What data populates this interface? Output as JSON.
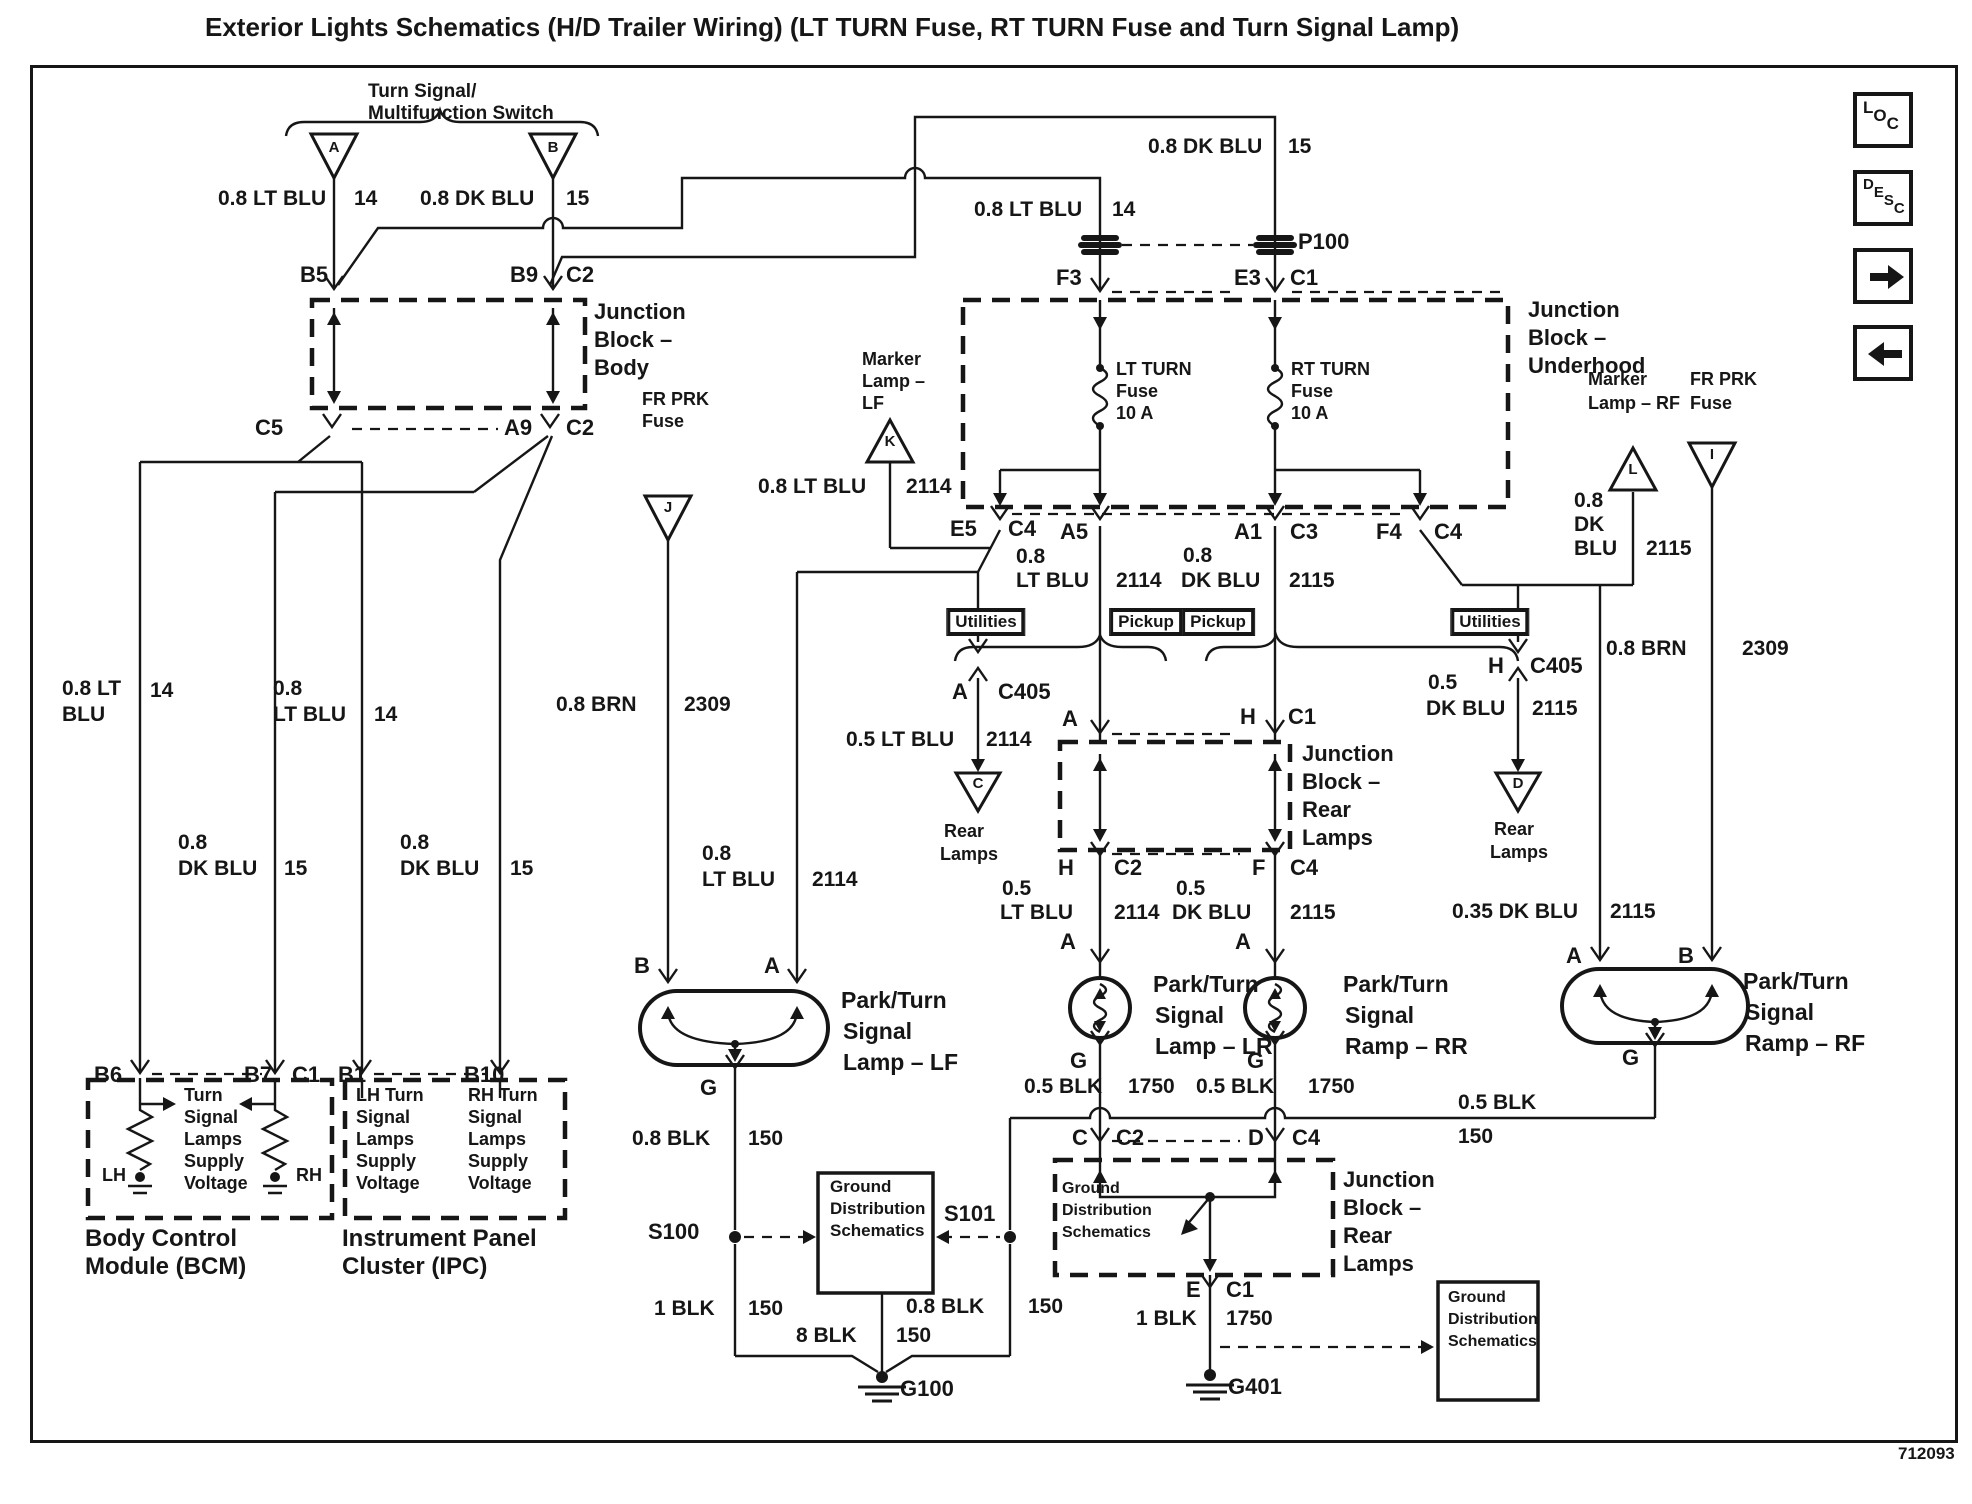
{
  "title": "Exterior Lights Schematics (H/D Trailer Wiring) (LT TURN Fuse, RT TURN Fuse and Turn Signal Lamp)",
  "part_number": "712093",
  "toolbar": {
    "loc_label": "LOC",
    "desc_label": "DESC",
    "next_icon": "right-arrow",
    "prev_icon": "left-arrow"
  },
  "colors": {
    "ink": "#161616",
    "paper": "#ffffff"
  },
  "labels": [
    {
      "t": "Turn Signal/",
      "x": 368,
      "y": 82,
      "s": 19
    },
    {
      "t": "Multifunction Switch",
      "x": 368,
      "y": 104,
      "s": 19
    },
    {
      "t": "A",
      "x": 334,
      "y": 140,
      "s": 15,
      "a": "c"
    },
    {
      "t": "B",
      "x": 553,
      "y": 140,
      "s": 15,
      "a": "c"
    },
    {
      "t": "0.8 LT BLU",
      "x": 218,
      "y": 188,
      "s": 21
    },
    {
      "t": "14",
      "x": 354,
      "y": 188,
      "s": 21
    },
    {
      "t": "0.8 DK BLU",
      "x": 420,
      "y": 188,
      "s": 21
    },
    {
      "t": "15",
      "x": 566,
      "y": 188,
      "s": 21
    },
    {
      "t": "B5",
      "x": 300,
      "y": 263,
      "s": 22
    },
    {
      "t": "B9",
      "x": 510,
      "y": 263,
      "s": 22
    },
    {
      "t": "C2",
      "x": 566,
      "y": 263,
      "s": 22
    },
    {
      "t": "Junction",
      "x": 594,
      "y": 300,
      "s": 22
    },
    {
      "t": "Block –",
      "x": 594,
      "y": 328,
      "s": 22
    },
    {
      "t": "Body",
      "x": 594,
      "y": 356,
      "s": 22
    },
    {
      "t": "C5",
      "x": 255,
      "y": 416,
      "s": 22
    },
    {
      "t": "A9",
      "x": 504,
      "y": 416,
      "s": 22
    },
    {
      "t": "C2",
      "x": 566,
      "y": 416,
      "s": 22
    },
    {
      "t": "0.8 DK BLU",
      "x": 1148,
      "y": 136,
      "s": 21
    },
    {
      "t": "15",
      "x": 1288,
      "y": 136,
      "s": 21
    },
    {
      "t": "0.8 LT BLU",
      "x": 974,
      "y": 199,
      "s": 21
    },
    {
      "t": "14",
      "x": 1112,
      "y": 199,
      "s": 21
    },
    {
      "t": "P100",
      "x": 1298,
      "y": 230,
      "s": 22
    },
    {
      "t": "F3",
      "x": 1056,
      "y": 266,
      "s": 22
    },
    {
      "t": "E3",
      "x": 1234,
      "y": 266,
      "s": 22
    },
    {
      "t": "C1",
      "x": 1290,
      "y": 266,
      "s": 22
    },
    {
      "t": "Junction",
      "x": 1528,
      "y": 298,
      "s": 22
    },
    {
      "t": "Block –",
      "x": 1528,
      "y": 326,
      "s": 22
    },
    {
      "t": "Underhood",
      "x": 1528,
      "y": 354,
      "s": 22
    },
    {
      "t": "LT TURN",
      "x": 1116,
      "y": 360,
      "s": 18
    },
    {
      "t": "Fuse",
      "x": 1116,
      "y": 382,
      "s": 18
    },
    {
      "t": "10 A",
      "x": 1116,
      "y": 404,
      "s": 18
    },
    {
      "t": "RT TURN",
      "x": 1291,
      "y": 360,
      "s": 18
    },
    {
      "t": "Fuse",
      "x": 1291,
      "y": 382,
      "s": 18
    },
    {
      "t": "10 A",
      "x": 1291,
      "y": 404,
      "s": 18
    },
    {
      "t": "Marker",
      "x": 862,
      "y": 350,
      "s": 18
    },
    {
      "t": "Lamp –",
      "x": 862,
      "y": 372,
      "s": 18
    },
    {
      "t": "LF",
      "x": 862,
      "y": 394,
      "s": 18
    },
    {
      "t": "K",
      "x": 890,
      "y": 434,
      "s": 15,
      "a": "c"
    },
    {
      "t": "FR PRK",
      "x": 642,
      "y": 390,
      "s": 18
    },
    {
      "t": "Fuse",
      "x": 642,
      "y": 412,
      "s": 18
    },
    {
      "t": "J",
      "x": 668,
      "y": 500,
      "s": 15,
      "a": "c"
    },
    {
      "t": "0.8 LT BLU",
      "x": 758,
      "y": 476,
      "s": 21
    },
    {
      "t": "2114",
      "x": 906,
      "y": 476,
      "s": 21
    },
    {
      "t": "E5",
      "x": 950,
      "y": 517,
      "s": 22
    },
    {
      "t": "C4",
      "x": 1008,
      "y": 517,
      "s": 22
    },
    {
      "t": "A5",
      "x": 1060,
      "y": 520,
      "s": 22
    },
    {
      "t": "A1",
      "x": 1234,
      "y": 520,
      "s": 22
    },
    {
      "t": "C3",
      "x": 1290,
      "y": 520,
      "s": 22
    },
    {
      "t": "F4",
      "x": 1376,
      "y": 520,
      "s": 22
    },
    {
      "t": "C4",
      "x": 1434,
      "y": 520,
      "s": 22
    },
    {
      "t": "0.8",
      "x": 1016,
      "y": 546,
      "s": 21
    },
    {
      "t": "LT BLU",
      "x": 1016,
      "y": 570,
      "s": 21
    },
    {
      "t": "2114",
      "x": 1116,
      "y": 570,
      "s": 21
    },
    {
      "t": "0.8",
      "x": 1183,
      "y": 545,
      "s": 21
    },
    {
      "t": "DK BLU",
      "x": 1181,
      "y": 570,
      "s": 21
    },
    {
      "t": "2115",
      "x": 1289,
      "y": 570,
      "s": 21
    },
    {
      "t": "Marker",
      "x": 1588,
      "y": 370,
      "s": 18
    },
    {
      "t": "Lamp – RF",
      "x": 1588,
      "y": 394,
      "s": 18
    },
    {
      "t": "L",
      "x": 1633,
      "y": 462,
      "s": 15,
      "a": "c"
    },
    {
      "t": "FR PRK",
      "x": 1690,
      "y": 370,
      "s": 18
    },
    {
      "t": "Fuse",
      "x": 1690,
      "y": 394,
      "s": 18
    },
    {
      "t": "I",
      "x": 1712,
      "y": 447,
      "s": 15,
      "a": "c"
    },
    {
      "t": "0.8",
      "x": 1574,
      "y": 490,
      "s": 21
    },
    {
      "t": "DK",
      "x": 1574,
      "y": 514,
      "s": 21
    },
    {
      "t": "BLU",
      "x": 1574,
      "y": 538,
      "s": 21
    },
    {
      "t": "2115",
      "x": 1646,
      "y": 538,
      "s": 21
    },
    {
      "t": "Utilities",
      "x": 986,
      "y": 609,
      "s": 17,
      "a": "c",
      "st": "tag"
    },
    {
      "t": "Pickup",
      "x": 1146,
      "y": 609,
      "s": 17,
      "a": "c",
      "st": "tag"
    },
    {
      "t": "Pickup",
      "x": 1218,
      "y": 609,
      "s": 17,
      "a": "c",
      "st": "tag"
    },
    {
      "t": "Utilities",
      "x": 1490,
      "y": 609,
      "s": 17,
      "a": "c",
      "st": "tag"
    },
    {
      "t": "A",
      "x": 952,
      "y": 680,
      "s": 22
    },
    {
      "t": "C405",
      "x": 998,
      "y": 680,
      "s": 22
    },
    {
      "t": "0.5 LT BLU",
      "x": 846,
      "y": 729,
      "s": 21
    },
    {
      "t": "2114",
      "x": 986,
      "y": 729,
      "s": 21
    },
    {
      "t": "C",
      "x": 978,
      "y": 776,
      "s": 15,
      "a": "c"
    },
    {
      "t": "Rear",
      "x": 944,
      "y": 822,
      "s": 18
    },
    {
      "t": "Lamps",
      "x": 940,
      "y": 845,
      "s": 18
    },
    {
      "t": "H",
      "x": 1488,
      "y": 654,
      "s": 22
    },
    {
      "t": "C405",
      "x": 1530,
      "y": 654,
      "s": 22
    },
    {
      "t": "0.5",
      "x": 1428,
      "y": 672,
      "s": 21
    },
    {
      "t": "DK BLU",
      "x": 1426,
      "y": 698,
      "s": 21
    },
    {
      "t": "2115",
      "x": 1532,
      "y": 698,
      "s": 21
    },
    {
      "t": "D",
      "x": 1518,
      "y": 776,
      "s": 15,
      "a": "c"
    },
    {
      "t": "Rear",
      "x": 1494,
      "y": 820,
      "s": 18
    },
    {
      "t": "Lamps",
      "x": 1490,
      "y": 843,
      "s": 18
    },
    {
      "t": "0.8 BRN",
      "x": 1606,
      "y": 638,
      "s": 21
    },
    {
      "t": "2309",
      "x": 1742,
      "y": 638,
      "s": 21
    },
    {
      "t": "A",
      "x": 1062,
      "y": 707,
      "s": 22
    },
    {
      "t": "H",
      "x": 1240,
      "y": 705,
      "s": 22
    },
    {
      "t": "C1",
      "x": 1288,
      "y": 705,
      "s": 22
    },
    {
      "t": "Junction",
      "x": 1302,
      "y": 742,
      "s": 22
    },
    {
      "t": "Block –",
      "x": 1302,
      "y": 770,
      "s": 22
    },
    {
      "t": "Rear",
      "x": 1302,
      "y": 798,
      "s": 22
    },
    {
      "t": "Lamps",
      "x": 1302,
      "y": 826,
      "s": 22
    },
    {
      "t": "H",
      "x": 1058,
      "y": 856,
      "s": 22
    },
    {
      "t": "C2",
      "x": 1114,
      "y": 856,
      "s": 22
    },
    {
      "t": "F",
      "x": 1252,
      "y": 856,
      "s": 22
    },
    {
      "t": "C4",
      "x": 1290,
      "y": 856,
      "s": 22
    },
    {
      "t": "0.5",
      "x": 1002,
      "y": 878,
      "s": 21
    },
    {
      "t": "LT BLU",
      "x": 1000,
      "y": 902,
      "s": 21
    },
    {
      "t": "2114",
      "x": 1114,
      "y": 902,
      "s": 21
    },
    {
      "t": "0.5",
      "x": 1176,
      "y": 878,
      "s": 21
    },
    {
      "t": "DK BLU",
      "x": 1172,
      "y": 902,
      "s": 21
    },
    {
      "t": "2115",
      "x": 1290,
      "y": 902,
      "s": 21
    },
    {
      "t": "0.35 DK BLU",
      "x": 1452,
      "y": 901,
      "s": 21
    },
    {
      "t": "2115",
      "x": 1610,
      "y": 901,
      "s": 21
    },
    {
      "t": "A",
      "x": 1060,
      "y": 930,
      "s": 22
    },
    {
      "t": "A",
      "x": 1235,
      "y": 930,
      "s": 22
    },
    {
      "t": "A",
      "x": 1566,
      "y": 944,
      "s": 22
    },
    {
      "t": "B",
      "x": 1678,
      "y": 944,
      "s": 22
    },
    {
      "t": "B",
      "x": 634,
      "y": 954,
      "s": 22
    },
    {
      "t": "A",
      "x": 764,
      "y": 954,
      "s": 22
    },
    {
      "t": "0.8",
      "x": 702,
      "y": 843,
      "s": 21
    },
    {
      "t": "LT BLU",
      "x": 702,
      "y": 869,
      "s": 21
    },
    {
      "t": "2114",
      "x": 812,
      "y": 869,
      "s": 21
    },
    {
      "t": "0.8 BRN",
      "x": 556,
      "y": 694,
      "s": 21
    },
    {
      "t": "2309",
      "x": 684,
      "y": 694,
      "s": 21
    },
    {
      "t": "Park/Turn",
      "x": 841,
      "y": 988,
      "s": 23
    },
    {
      "t": "Signal",
      "x": 843,
      "y": 1019,
      "s": 23
    },
    {
      "t": "Lamp – LF",
      "x": 843,
      "y": 1050,
      "s": 23
    },
    {
      "t": "Park/Turn",
      "x": 1153,
      "y": 972,
      "s": 23
    },
    {
      "t": "Signal",
      "x": 1155,
      "y": 1003,
      "s": 23
    },
    {
      "t": "Lamp – LR",
      "x": 1155,
      "y": 1034,
      "s": 23
    },
    {
      "t": "Park/Turn",
      "x": 1343,
      "y": 972,
      "s": 23
    },
    {
      "t": "Signal",
      "x": 1345,
      "y": 1003,
      "s": 23
    },
    {
      "t": "Ramp – RR",
      "x": 1345,
      "y": 1034,
      "s": 23
    },
    {
      "t": "Park/Turn",
      "x": 1743,
      "y": 969,
      "s": 23
    },
    {
      "t": "Signal",
      "x": 1745,
      "y": 1000,
      "s": 23
    },
    {
      "t": "Ramp – RF",
      "x": 1745,
      "y": 1031,
      "s": 23
    },
    {
      "t": "G",
      "x": 700,
      "y": 1076,
      "s": 22
    },
    {
      "t": "G",
      "x": 1070,
      "y": 1049,
      "s": 22
    },
    {
      "t": "G",
      "x": 1247,
      "y": 1049,
      "s": 22
    },
    {
      "t": "G",
      "x": 1622,
      "y": 1046,
      "s": 22
    },
    {
      "t": "0.8 BLK",
      "x": 632,
      "y": 1128,
      "s": 21
    },
    {
      "t": "150",
      "x": 748,
      "y": 1128,
      "s": 21
    },
    {
      "t": "0.5 BLK",
      "x": 1024,
      "y": 1076,
      "s": 21
    },
    {
      "t": "1750",
      "x": 1128,
      "y": 1076,
      "s": 21
    },
    {
      "t": "0.5 BLK",
      "x": 1196,
      "y": 1076,
      "s": 21
    },
    {
      "t": "1750",
      "x": 1308,
      "y": 1076,
      "s": 21
    },
    {
      "t": "0.5 BLK",
      "x": 1458,
      "y": 1092,
      "s": 21
    },
    {
      "t": "150",
      "x": 1458,
      "y": 1126,
      "s": 21
    },
    {
      "t": "C",
      "x": 1072,
      "y": 1126,
      "s": 22
    },
    {
      "t": "C2",
      "x": 1116,
      "y": 1126,
      "s": 22
    },
    {
      "t": "D",
      "x": 1248,
      "y": 1126,
      "s": 22
    },
    {
      "t": "C4",
      "x": 1292,
      "y": 1126,
      "s": 22
    },
    {
      "t": "S100",
      "x": 648,
      "y": 1220,
      "s": 22
    },
    {
      "t": "S101",
      "x": 944,
      "y": 1202,
      "s": 22
    },
    {
      "t": "Ground",
      "x": 830,
      "y": 1178,
      "s": 17
    },
    {
      "t": "Distribution",
      "x": 830,
      "y": 1200,
      "s": 17
    },
    {
      "t": "Schematics",
      "x": 830,
      "y": 1222,
      "s": 17
    },
    {
      "t": "Ground",
      "x": 1062,
      "y": 1181,
      "s": 16
    },
    {
      "t": "Distribution",
      "x": 1062,
      "y": 1203,
      "s": 16
    },
    {
      "t": "Schematics",
      "x": 1062,
      "y": 1225,
      "s": 16
    },
    {
      "t": "Junction",
      "x": 1343,
      "y": 1168,
      "s": 22
    },
    {
      "t": "Block –",
      "x": 1343,
      "y": 1196,
      "s": 22
    },
    {
      "t": "Rear",
      "x": 1343,
      "y": 1224,
      "s": 22
    },
    {
      "t": "Lamps",
      "x": 1343,
      "y": 1252,
      "s": 22
    },
    {
      "t": "1 BLK",
      "x": 654,
      "y": 1298,
      "s": 21
    },
    {
      "t": "150",
      "x": 748,
      "y": 1298,
      "s": 21
    },
    {
      "t": "0.8 BLK",
      "x": 906,
      "y": 1296,
      "s": 21
    },
    {
      "t": "150",
      "x": 1028,
      "y": 1296,
      "s": 21
    },
    {
      "t": "8 BLK",
      "x": 796,
      "y": 1325,
      "s": 21
    },
    {
      "t": "150",
      "x": 896,
      "y": 1325,
      "s": 21
    },
    {
      "t": "G100",
      "x": 900,
      "y": 1377,
      "s": 22
    },
    {
      "t": "E",
      "x": 1186,
      "y": 1278,
      "s": 22
    },
    {
      "t": "C1",
      "x": 1226,
      "y": 1278,
      "s": 22
    },
    {
      "t": "1 BLK",
      "x": 1136,
      "y": 1308,
      "s": 21
    },
    {
      "t": "1750",
      "x": 1226,
      "y": 1308,
      "s": 21
    },
    {
      "t": "G401",
      "x": 1228,
      "y": 1375,
      "s": 22
    },
    {
      "t": "Ground",
      "x": 1448,
      "y": 1290,
      "s": 16
    },
    {
      "t": "Distribution",
      "x": 1448,
      "y": 1312,
      "s": 16
    },
    {
      "t": "Schematics",
      "x": 1448,
      "y": 1334,
      "s": 16
    },
    {
      "t": "B6",
      "x": 94,
      "y": 1063,
      "s": 22
    },
    {
      "t": "B7",
      "x": 244,
      "y": 1063,
      "s": 22
    },
    {
      "t": "C1",
      "x": 292,
      "y": 1063,
      "s": 22
    },
    {
      "t": "B1",
      "x": 338,
      "y": 1063,
      "s": 22
    },
    {
      "t": "B10",
      "x": 464,
      "y": 1063,
      "s": 22
    },
    {
      "t": "Turn",
      "x": 184,
      "y": 1086,
      "s": 18
    },
    {
      "t": "Signal",
      "x": 184,
      "y": 1108,
      "s": 18
    },
    {
      "t": "Lamps",
      "x": 184,
      "y": 1130,
      "s": 18
    },
    {
      "t": "Supply",
      "x": 184,
      "y": 1152,
      "s": 18
    },
    {
      "t": "Voltage",
      "x": 184,
      "y": 1174,
      "s": 18
    },
    {
      "t": "LH",
      "x": 102,
      "y": 1166,
      "s": 18
    },
    {
      "t": "RH",
      "x": 296,
      "y": 1166,
      "s": 18
    },
    {
      "t": "LH Turn",
      "x": 356,
      "y": 1086,
      "s": 18
    },
    {
      "t": "Signal",
      "x": 356,
      "y": 1108,
      "s": 18
    },
    {
      "t": "Lamps",
      "x": 356,
      "y": 1130,
      "s": 18
    },
    {
      "t": "Supply",
      "x": 356,
      "y": 1152,
      "s": 18
    },
    {
      "t": "Voltage",
      "x": 356,
      "y": 1174,
      "s": 18
    },
    {
      "t": "RH Turn",
      "x": 468,
      "y": 1086,
      "s": 18
    },
    {
      "t": "Signal",
      "x": 468,
      "y": 1108,
      "s": 18
    },
    {
      "t": "Lamps",
      "x": 468,
      "y": 1130,
      "s": 18
    },
    {
      "t": "Supply",
      "x": 468,
      "y": 1152,
      "s": 18
    },
    {
      "t": "Voltage",
      "x": 468,
      "y": 1174,
      "s": 18
    },
    {
      "t": "Body Control",
      "x": 85,
      "y": 1226,
      "s": 24
    },
    {
      "t": "Module (BCM)",
      "x": 85,
      "y": 1254,
      "s": 24
    },
    {
      "t": "Instrument Panel",
      "x": 342,
      "y": 1226,
      "s": 24
    },
    {
      "t": "Cluster (IPC)",
      "x": 342,
      "y": 1254,
      "s": 24
    },
    {
      "t": "0.8 LT",
      "x": 62,
      "y": 678,
      "s": 21
    },
    {
      "t": "BLU",
      "x": 62,
      "y": 704,
      "s": 21
    },
    {
      "t": "14",
      "x": 150,
      "y": 680,
      "s": 21
    },
    {
      "t": "0.8",
      "x": 273,
      "y": 678,
      "s": 21
    },
    {
      "t": "LT BLU",
      "x": 273,
      "y": 704,
      "s": 21
    },
    {
      "t": "14",
      "x": 374,
      "y": 704,
      "s": 21
    },
    {
      "t": "0.8",
      "x": 178,
      "y": 832,
      "s": 21
    },
    {
      "t": "DK BLU",
      "x": 178,
      "y": 858,
      "s": 21
    },
    {
      "t": "15",
      "x": 284,
      "y": 858,
      "s": 21
    },
    {
      "t": "0.8",
      "x": 400,
      "y": 832,
      "s": 21
    },
    {
      "t": "DK BLU",
      "x": 400,
      "y": 858,
      "s": 21
    },
    {
      "t": "15",
      "x": 510,
      "y": 858,
      "s": 21
    }
  ]
}
